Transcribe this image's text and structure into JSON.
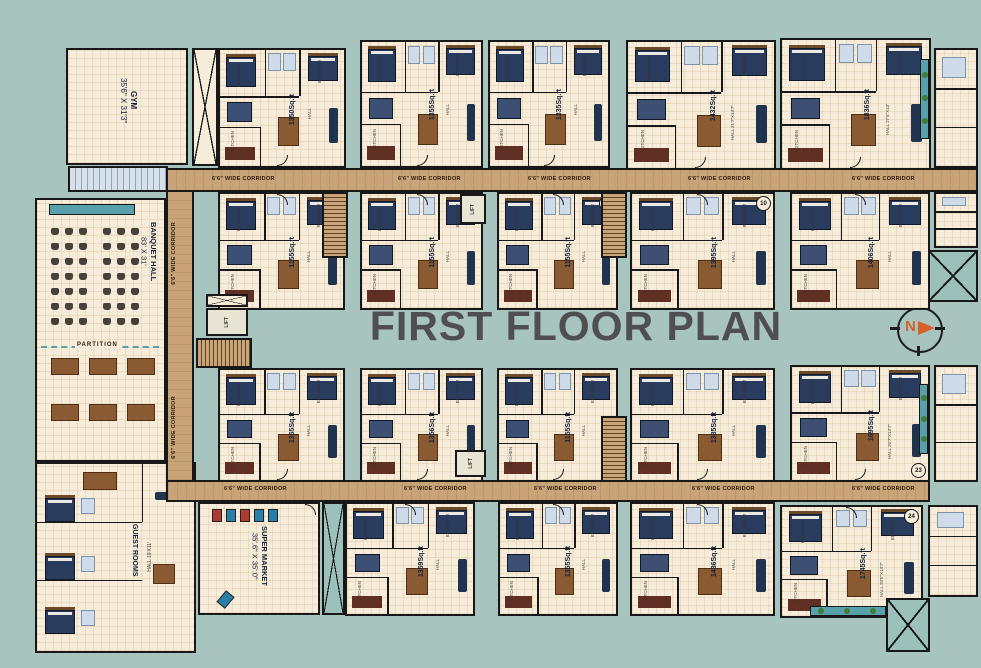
{
  "title": "FIRST FLOOR PLAN",
  "compass_label": "N",
  "corridor_label": "6'6\" WIDE CORRIDOR",
  "lift_label": "LIFT",
  "lift_dims": "8'X8'6\"",
  "partition_label": "PARTITION",
  "gym": {
    "name": "GYM",
    "dims": "35'6\" X 31'3\""
  },
  "banquet": {
    "name": "BANQUET HALL",
    "dims": "83' X 31'"
  },
  "supermarket": {
    "name": "SUPER MARKET",
    "dims": "35'.6\" X 35'.0\""
  },
  "guest_rooms": {
    "name": "GUEST ROOMS",
    "hall": "HALL 19'X11'"
  },
  "room_labels": {
    "bedroom": "BEDROOM",
    "hall": "HALL",
    "kitchen": "KITCHEN",
    "toilet": "TOILET",
    "dining": "DINING"
  },
  "colors": {
    "background": "#a8c4bf",
    "floor": "#f6ecd9",
    "corridor": "#c8a478",
    "wall": "#181818",
    "accent_teal": "#58a0ac",
    "title_gray": "#4f4f4f",
    "compass_orange": "#d4622a"
  },
  "units": [
    {
      "area": "1350Sq.ft",
      "x": 218,
      "y": 48,
      "w": 128,
      "h": 120,
      "door": "bottom"
    },
    {
      "area": "1355Sq.ft",
      "x": 360,
      "y": 40,
      "w": 123,
      "h": 128,
      "door": "bottom"
    },
    {
      "area": "1335Sq.ft",
      "x": 488,
      "y": 40,
      "w": 122,
      "h": 128,
      "door": "bottom"
    },
    {
      "area": "1432Sq.ft",
      "x": 626,
      "y": 40,
      "w": 150,
      "h": 130,
      "door": "bottom",
      "hall": "HALL 21'7\"X13'7\""
    },
    {
      "area": "1836Sq.ft",
      "x": 780,
      "y": 38,
      "w": 151,
      "h": 132,
      "door": "bottom",
      "hall": "HALL 27'5\"X13'",
      "balcony": "right"
    },
    {
      "area": "1155Sq.ft",
      "x": 218,
      "y": 192,
      "w": 127,
      "h": 118,
      "door": "top"
    },
    {
      "area": "1155Sq.ft",
      "x": 360,
      "y": 192,
      "w": 123,
      "h": 118,
      "door": "top",
      "circ": "08"
    },
    {
      "area": "1155Sq.ft",
      "x": 497,
      "y": 192,
      "w": 121,
      "h": 118,
      "door": "top",
      "circ": "09"
    },
    {
      "area": "1395Sq.ft",
      "x": 630,
      "y": 192,
      "w": 145,
      "h": 118,
      "door": "top",
      "circ": "10"
    },
    {
      "area": "1406Sq.ft",
      "x": 790,
      "y": 192,
      "w": 140,
      "h": 118,
      "door": "top"
    },
    {
      "area": "1355Sq.ft",
      "x": 218,
      "y": 368,
      "w": 127,
      "h": 114,
      "door": "bottom"
    },
    {
      "area": "1356Sq.ft",
      "x": 360,
      "y": 368,
      "w": 123,
      "h": 114,
      "door": "bottom"
    },
    {
      "area": "1155Sq.ft",
      "x": 497,
      "y": 368,
      "w": 121,
      "h": 114,
      "door": "bottom"
    },
    {
      "area": "1385Sq.ft",
      "x": 630,
      "y": 368,
      "w": 145,
      "h": 114,
      "door": "bottom"
    },
    {
      "area": "1695Sq.ft",
      "x": 790,
      "y": 365,
      "w": 140,
      "h": 117,
      "door": "bottom",
      "circ": "23",
      "hall": "HALL 25'7\"X13'7\"",
      "balcony": "right"
    },
    {
      "area": "1359Sq.ft",
      "x": 345,
      "y": 502,
      "w": 130,
      "h": 114,
      "door": "top"
    },
    {
      "area": "1355Sq.ft",
      "x": 498,
      "y": 502,
      "w": 120,
      "h": 114,
      "door": "top"
    },
    {
      "area": "1436Sq.ft",
      "x": 630,
      "y": 502,
      "w": 145,
      "h": 114,
      "door": "top"
    },
    {
      "area": "1745Sq.ft",
      "x": 780,
      "y": 505,
      "w": 143,
      "h": 113,
      "door": "top",
      "circ": "24",
      "hall": "HALL 20'5\"X13'7\"",
      "balcony": "bottom"
    }
  ],
  "geometry": {
    "corridors": [
      {
        "x": 138,
        "y": 168,
        "w": 840,
        "h": 24
      },
      {
        "x": 166,
        "y": 480,
        "w": 764,
        "h": 22
      },
      {
        "x": 166,
        "y": 190,
        "w": 28,
        "h": 292,
        "v": true
      }
    ],
    "corridor_labels": [
      {
        "x": 212,
        "y": 176
      },
      {
        "x": 398,
        "y": 176
      },
      {
        "x": 528,
        "y": 176
      },
      {
        "x": 688,
        "y": 176
      },
      {
        "x": 852,
        "y": 176
      },
      {
        "x": 224,
        "y": 486
      },
      {
        "x": 404,
        "y": 486
      },
      {
        "x": 534,
        "y": 486
      },
      {
        "x": 692,
        "y": 486
      },
      {
        "x": 852,
        "y": 486
      },
      {
        "x": 171,
        "y": 222,
        "v": true
      },
      {
        "x": 171,
        "y": 396,
        "v": true
      }
    ],
    "stairs": [
      {
        "x": 322,
        "y": 192,
        "w": 26,
        "h": 66
      },
      {
        "x": 601,
        "y": 192,
        "w": 26,
        "h": 66
      },
      {
        "x": 601,
        "y": 416,
        "w": 26,
        "h": 66
      },
      {
        "x": 196,
        "y": 338,
        "w": 56,
        "h": 30,
        "horiz": true
      }
    ],
    "lifts": [
      {
        "x": 460,
        "y": 194,
        "w": 26,
        "h": 30
      },
      {
        "x": 206,
        "y": 308,
        "w": 42,
        "h": 28
      },
      {
        "x": 455,
        "y": 450,
        "w": 31,
        "h": 27
      }
    ],
    "shafts_cream": [
      {
        "x": 192,
        "y": 48,
        "w": 26,
        "h": 118
      },
      {
        "x": 206,
        "y": 294,
        "w": 42,
        "h": 13
      }
    ],
    "shafts_teal": [
      {
        "x": 322,
        "y": 502,
        "w": 23,
        "h": 113
      },
      {
        "x": 928,
        "y": 250,
        "w": 50,
        "h": 52
      },
      {
        "x": 886,
        "y": 598,
        "w": 44,
        "h": 54
      }
    ],
    "right_strips": [
      {
        "x": 934,
        "y": 48,
        "w": 44,
        "h": 120
      },
      {
        "x": 934,
        "y": 192,
        "w": 44,
        "h": 56
      },
      {
        "x": 934,
        "y": 365,
        "w": 44,
        "h": 117
      },
      {
        "x": 928,
        "y": 505,
        "w": 50,
        "h": 92
      }
    ],
    "gym": {
      "x": 66,
      "y": 48,
      "w": 122,
      "h": 117
    },
    "toilet_strip": {
      "x": 68,
      "y": 166,
      "w": 100,
      "h": 26
    },
    "banquet": {
      "x": 35,
      "y": 198,
      "w": 131,
      "h": 264
    },
    "guest": {
      "x": 35,
      "y": 462,
      "w": 161,
      "h": 191
    },
    "supermarket": {
      "x": 198,
      "y": 502,
      "w": 122,
      "h": 113
    }
  }
}
